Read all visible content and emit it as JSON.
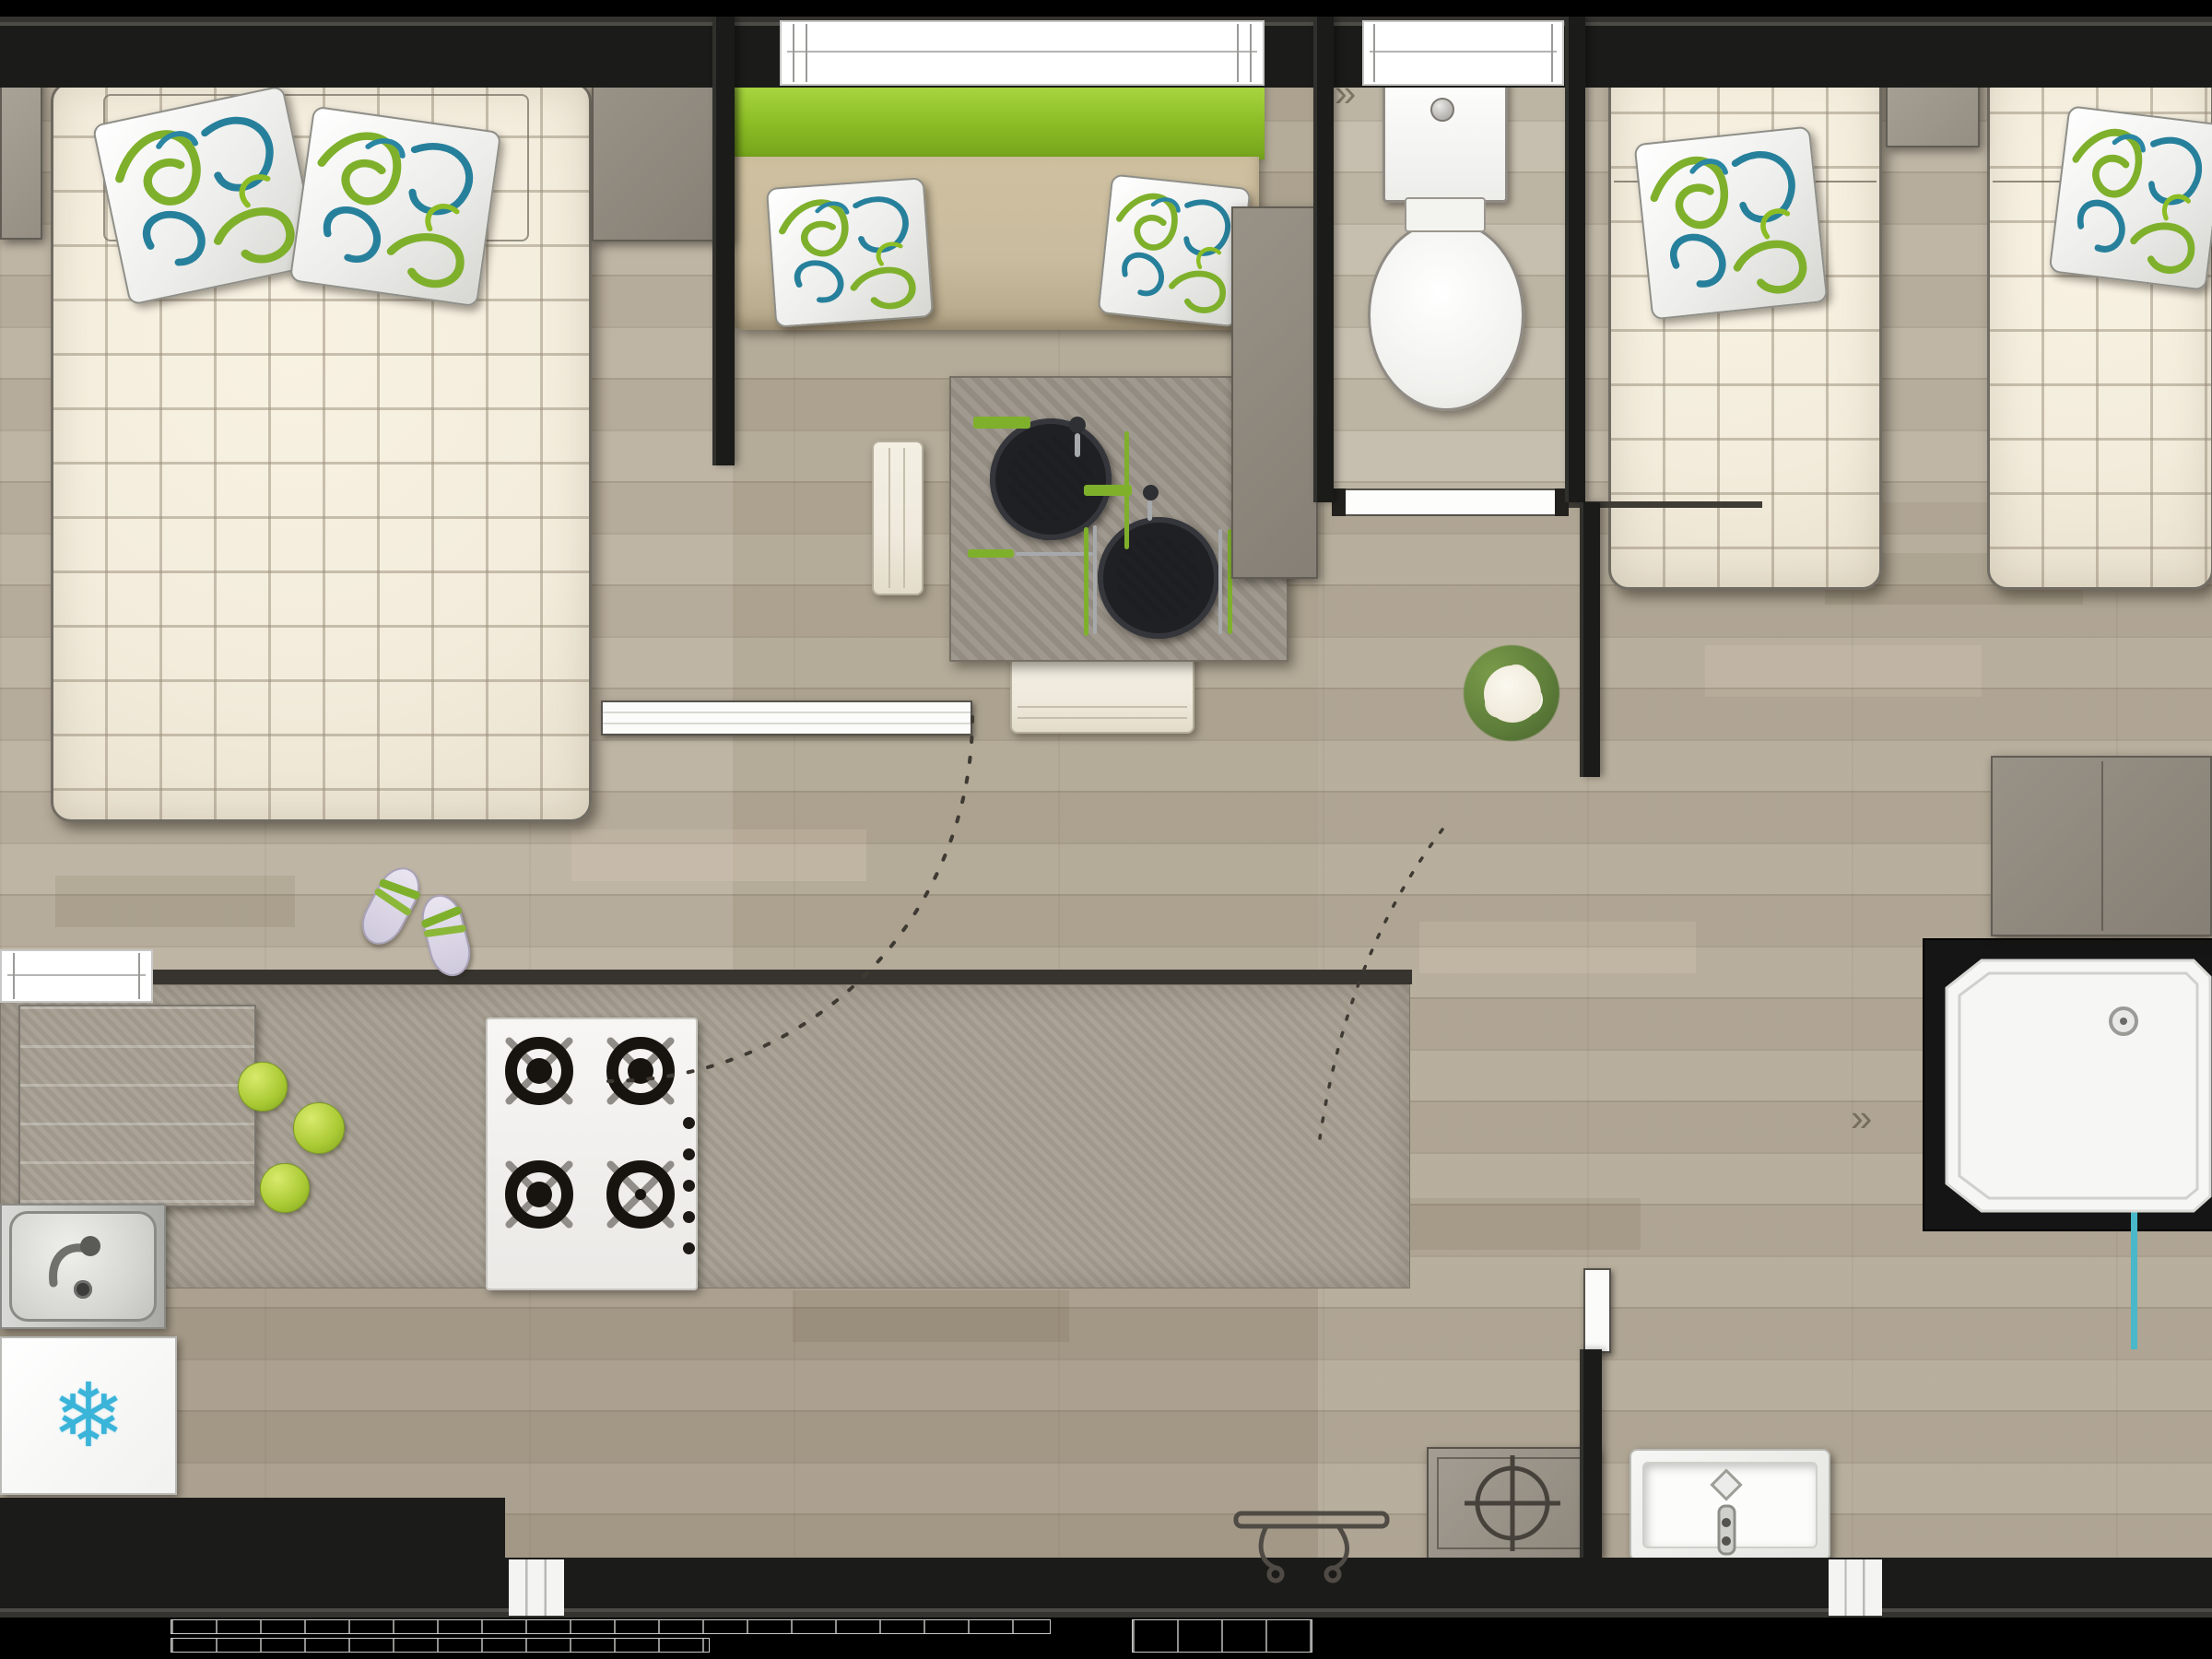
{
  "meta": {
    "type": "floor-plan",
    "description": "Top-down architectural rendering of a mobile home: double bedroom, living-dining area with sofa and table, kitchen with hob and sink, fridge, toilet room, twin bedroom and shower room"
  },
  "icons": {
    "fridge-snowflake": "❄",
    "floor-chevron": "»"
  },
  "colors": {
    "wall": "#1b1b19",
    "floor": "#b2a896",
    "mattress": "#f3ecdc",
    "accent-green": "#8cbd25",
    "pillow-green": "#7fb02c",
    "pillow-teal": "#27809b",
    "plate-lime": "#cdd44b",
    "plate-ring": "#1f2024",
    "unit-grey": "#8d877c",
    "counter": "#a59e91",
    "table": "#9b9489",
    "sofa-seat": "#c9bb9e",
    "bench": "#efeadd",
    "snowflake-blue": "#3bb4d9",
    "tray-white": "#f6f6f4",
    "dash-line": "#3e3a33"
  }
}
